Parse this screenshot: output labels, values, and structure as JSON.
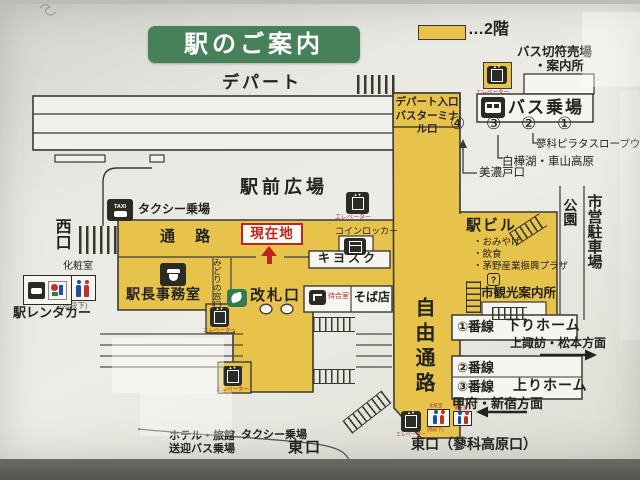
{
  "sign_title": "駅のご案内",
  "legend": {
    "floor2": "…2階"
  },
  "north": {
    "depart": "デパート",
    "plaza": "駅前広場",
    "taxi": "タクシー乗場",
    "taxi_icon": "TAXI",
    "west_exit": "西口"
  },
  "elevator_label": "エレベーター",
  "concourse": {
    "passage": "通 路",
    "you_are_here": "現在地",
    "stationmaster_office": "駅長事務室",
    "midori_window": "みどりの窓口",
    "ticket_gate": "改札口",
    "coin_locker": "コインロッカー",
    "kiosk": "キヨスク",
    "waiting_room": "待合室",
    "soba_shop": "そば店"
  },
  "west": {
    "restroom": "化粧室",
    "under_stairs": "(階段下)",
    "rent_a_car": "駅レンタカー"
  },
  "passage_south": {
    "free_passage": "自由通路",
    "east_exit_full": "東口（蓼科高原口）",
    "restroom": "化粧室",
    "under_stairs": "(階段下)"
  },
  "bus": {
    "entrance1": "デパート入口",
    "entrance2": "バスターミナル口",
    "ticket1": "バス切符売場",
    "ticket2": "・案内所",
    "stop": "バス乗場",
    "no4": "④",
    "no3": "③",
    "no2": "②",
    "no1": "①",
    "ropeway": "蓼科ピラタスロープウェイ",
    "shirakaba": "白樺湖・車山高原",
    "minotoguchi": "美濃戸口"
  },
  "building": {
    "name": "駅ビル",
    "item1": "・おみやげ",
    "item2": "・飲食",
    "item3": "・茅野産業振興プラザ",
    "q": "?",
    "tourist_info": "市観光案内所"
  },
  "east": {
    "park": "公園",
    "city_parking": "市営駐車場"
  },
  "platforms": {
    "no1": "①番線",
    "down": "下りホーム",
    "down_dir": "上諏訪・松本方面",
    "no2": "②番線",
    "no3": "③番線",
    "up": "上りホーム",
    "up_dir": "甲府・新宿方面",
    "restroom": "化粧室"
  },
  "south": {
    "hotel1": "ホテル・旅館",
    "hotel2": "送迎バス乗場",
    "taxi": "タクシー乗場",
    "east_exit": "東口"
  },
  "colors": {
    "yellow": "#e8c34b",
    "green": "#47815a",
    "red": "#c0241c"
  }
}
